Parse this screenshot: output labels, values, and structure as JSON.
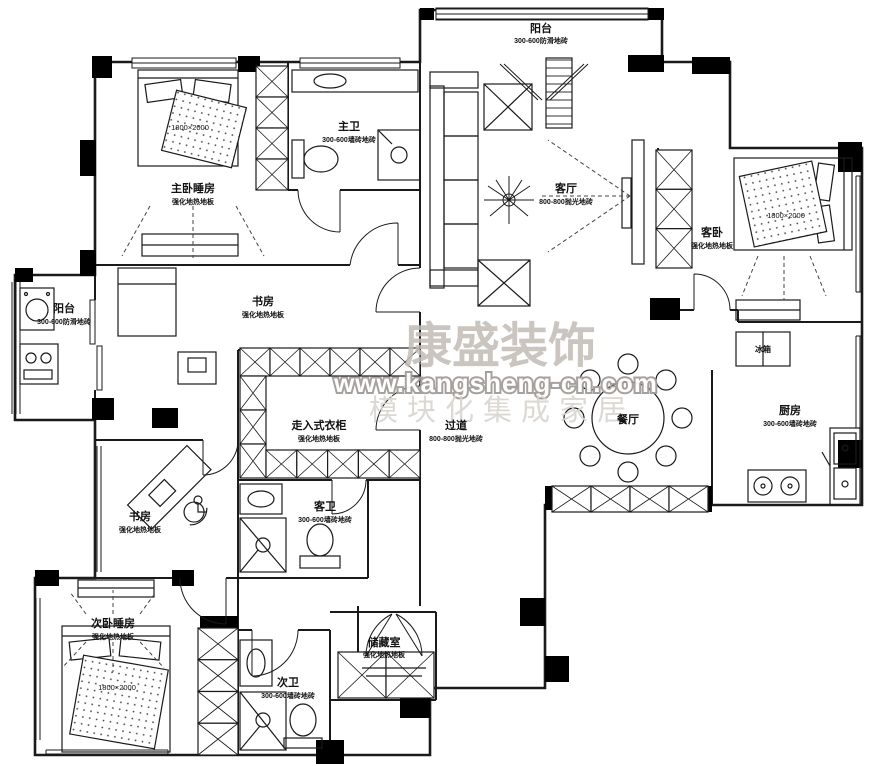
{
  "watermark": {
    "title": "康盛装饰",
    "url": "www.kangsheng-cn.com",
    "slogan": "模块化集成家居"
  },
  "rooms": {
    "balcony_top": {
      "name": "阳台",
      "finish": "300-600防滑地砖"
    },
    "master_bedroom": {
      "name": "主卧睡房",
      "finish": "强化地热地板",
      "bed_size": "1800×2000"
    },
    "master_bath": {
      "name": "主卫",
      "finish": "300-600墙砖地砖"
    },
    "living": {
      "name": "客厅",
      "finish": "800-800抛光地砖"
    },
    "guest_bedroom": {
      "name": "客卧",
      "finish": "强化地热地板",
      "bed_size": "1800×2000"
    },
    "study_upper": {
      "name": "书房",
      "finish": "强化地热地板"
    },
    "balcony_left": {
      "name": "阳台",
      "finish": "300-600防滑地砖"
    },
    "closet": {
      "name": "走入式衣柜",
      "finish": "强化地热地板"
    },
    "hallway": {
      "name": "过道",
      "finish": "800-800抛光地砖"
    },
    "dining": {
      "name": "餐厅"
    },
    "kitchen": {
      "name": "厨房",
      "finish": "300-600墙砖地砖",
      "fridge": "冰箱"
    },
    "study_lower": {
      "name": "书房",
      "finish": "强化地热地板"
    },
    "guest_bath": {
      "name": "客卫",
      "finish": "300-600墙砖地砖"
    },
    "second_bedroom": {
      "name": "次卧睡房",
      "finish": "强化地热地板",
      "bed_size": "1800×2000"
    },
    "storage": {
      "name": "储藏室",
      "finish": "强化地热地板"
    },
    "second_bath": {
      "name": "次卫",
      "finish": "300-600墙砖地砖"
    }
  },
  "colors": {
    "wall": "#1a1a1a",
    "watermark": "#c3bbb5"
  }
}
